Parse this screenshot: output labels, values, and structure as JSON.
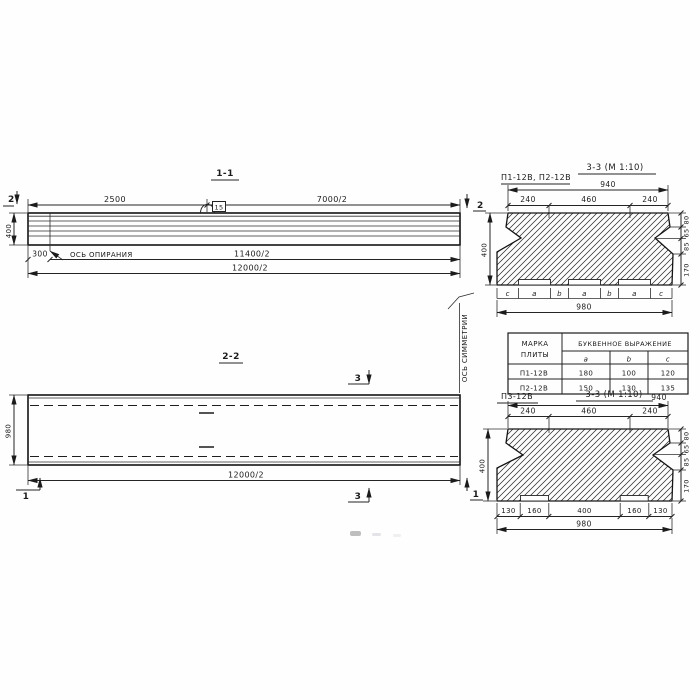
{
  "section_1_1": {
    "title": "1-1",
    "cut_marker": "2",
    "dim_2500": "2500",
    "dim_7000_2": "7000/2",
    "dim_400": "400",
    "dim_300": "300",
    "support_axis_label": "ОСЬ ОПИРАНИЯ",
    "hook_tag": "15",
    "dim_11400_2": "11400/2",
    "dim_12000_2": "12000/2"
  },
  "symmetry_axis_label": "ОСЬ СИММЕТРИИ",
  "section_2_2": {
    "title": "2-2",
    "cut_marker_3": "3",
    "cut_marker_1": "1",
    "dim_980": "980",
    "dim_12000_2": "12000/2"
  },
  "section_3_3_top": {
    "label": "П1-12В, П2-12В",
    "title": "3-3 (М 1:10)",
    "dim_940": "940",
    "top_segments": [
      "240",
      "460",
      "240"
    ],
    "dim_400": "400",
    "side_dims": [
      "80",
      "65",
      "85",
      "170"
    ],
    "bottom_letters": [
      "c",
      "a",
      "b",
      "a",
      "b",
      "a",
      "c"
    ],
    "dim_980": "980"
  },
  "plate_table": {
    "header_mark_top": "МАРКА",
    "header_mark_bottom": "ПЛИТЫ",
    "header_expression": "БУКВЕННОЕ ВЫРАЖЕНИЕ",
    "subcolumns": [
      "a",
      "b",
      "c"
    ],
    "rows": [
      {
        "mark": "П1-12В",
        "a": "180",
        "b": "100",
        "c": "120"
      },
      {
        "mark": "П2-12В",
        "a": "150",
        "b": "130",
        "c": "135"
      }
    ]
  },
  "section_3_3_bottom": {
    "label": "П3-12В",
    "title": "3-3 (М 1:10)",
    "dim_940": "940",
    "top_segments": [
      "240",
      "460",
      "240"
    ],
    "dim_400": "400",
    "side_dims": [
      "80",
      "65",
      "85",
      "170"
    ],
    "bottom_segments": [
      "130",
      "160",
      "400",
      "160",
      "130"
    ],
    "dim_980": "980"
  }
}
